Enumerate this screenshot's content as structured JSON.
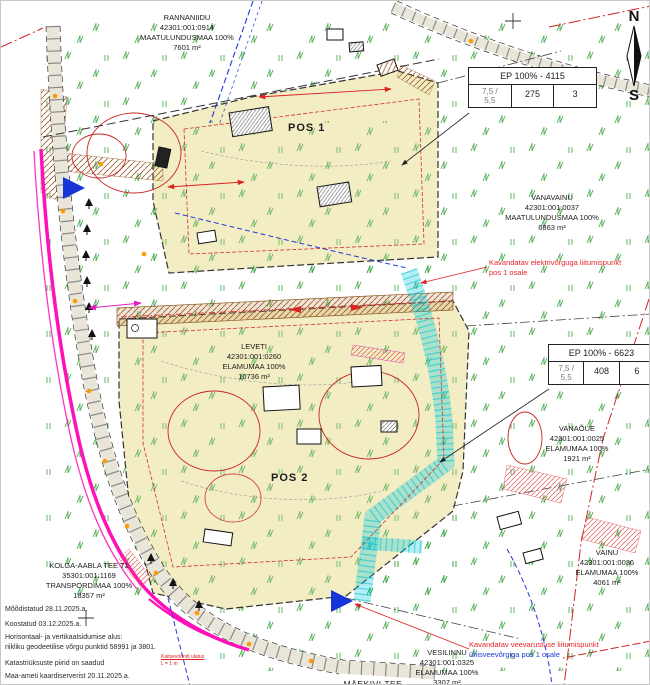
{
  "compass": {
    "north": "N",
    "south": "S"
  },
  "pos_labels": {
    "pos1": "POS 1",
    "pos2": "POS 2"
  },
  "parcels": {
    "rannaniidu": {
      "name": "RANNANIIDU",
      "code": "42301:001:0914",
      "use": "MAATULUNDUSMAA 100%",
      "area": "7601 m²"
    },
    "vanavainu": {
      "name": "VANAVAINU",
      "code": "42301:001:0037",
      "use": "MAATULUNDUSMAA 100%",
      "area": "6863 m²"
    },
    "leveti": {
      "name": "LEVETI",
      "code": "42301:001:0260",
      "use": "ELAMUMAA 100%",
      "area": "10736 m²"
    },
    "vanaoue": {
      "name": "VANAÕUE",
      "code": "42301:001:0025",
      "use": "ELAMUMAA 100%",
      "area": "1921 m²"
    },
    "vainu": {
      "name": "VAINU",
      "code": "42301:001:0036",
      "use": "ELAMUMAA 100%",
      "area": "4061 m²"
    },
    "kolga": {
      "name": "KOLGA-AABLA TEE T1",
      "code": "35301:001:1169",
      "use": "TRANSPORDIMAA 100%",
      "area": "18357 m²"
    },
    "vesilinnu": {
      "name": "VESILINNU",
      "code": "42301:001:0325",
      "use": "ELAMUMAA 100%",
      "area": "3307 m²"
    },
    "maekivi": {
      "name": "MÄEKIVI TEE"
    }
  },
  "tables": {
    "t1": {
      "header": "EP 100% - 4115",
      "c1a": "7,5 /",
      "c1b": "5,5",
      "c2": "275",
      "c3": "3"
    },
    "t2": {
      "header": "EP 100% - 6623",
      "c1a": "7,5 /",
      "c1b": "5,5",
      "c2": "408",
      "c3": "6"
    }
  },
  "annotations": {
    "electric": {
      "line1": "Kavandatav elektrivõrguga liitumispunkt",
      "line2": "pos 1 osale"
    },
    "water": {
      "line1": "Kavandatav veevarustuse liitumispunkt",
      "line2": "ühisveevõrgiga pos 1 osale"
    },
    "protection": {
      "line1": "Kaitsevööndi ulatus",
      "line2": "L = 1 m"
    }
  },
  "notes": [
    "Mõõdistatud 28.11.2025.a.",
    "Koostatud 03.12.2025.a.",
    "Horisontaal- ja vertikaalsidumise alus:",
    "riikliku geodeetilise võrgu punktid 58991 ja 3801.",
    "Katastriüksuste piirid on saadud",
    "Maa-ameti kaardiserverist 20.11.2025.a."
  ],
  "colors": {
    "parcel_fill": "#f3edc4",
    "road_magenta": "#ff10b8",
    "water_cyan": "#00c3d6",
    "restriction_red": "#cc2222",
    "vegetation_green": "#2f9e33",
    "annotation_red": "#e8262a",
    "annotation_blue": "#2038d8"
  }
}
